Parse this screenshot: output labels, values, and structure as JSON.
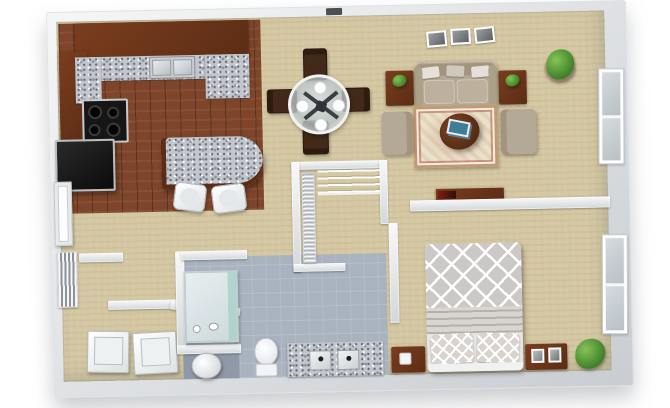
{
  "scene": {
    "type": "3d-floor-plan-render",
    "description": "Top-down 3D rendering of a one-bedroom one-bath apartment floor plan, no text labels",
    "view": "top-down with slight perspective tilt"
  },
  "colors": {
    "background": "#ffffff",
    "wall_mid": "#c9cdd1",
    "carpet": "#d4c7a1",
    "wood_floor": "#7e452a",
    "cabinet": "#5c2d15",
    "cabinet_light": "#7a3d1e",
    "granite": "#c3c7cd",
    "tile": "#a9b3bf",
    "tile_dark": "#8f99a7",
    "glass_shower": "#a8cfc9",
    "black_appliance": "#161616",
    "white_fixture": "#f4f6f7",
    "sofa": "#b4a896",
    "pillow": "#e6e1d8",
    "rug": "#eae1cb",
    "rug_border": "#bf9a72",
    "dark_wood": "#5f3319",
    "plant": "#4e8f33",
    "plant_dark": "#2f6b1e",
    "bed_cover": "#ccc8c5",
    "magazine_blue": "#3e7d96"
  },
  "rooms": [
    {
      "id": "kitchen",
      "name": "Kitchen",
      "floor": "hardwood",
      "items": [
        "L-shaped cherry-wood cabinets",
        "granite countertops",
        "double-basin sink",
        "four-burner cooktop",
        "refrigerator",
        "granite breakfast bar",
        "two bar stools"
      ]
    },
    {
      "id": "dining",
      "name": "Dining Area",
      "floor": "carpet",
      "items": [
        "round glass dining table",
        "four dark-wood dining chairs",
        "four white place settings"
      ]
    },
    {
      "id": "living",
      "name": "Living Room",
      "floor": "carpet",
      "items": [
        "three-cushion sofa with throw pillows",
        "two end tables with plants",
        "two armchairs",
        "oval wood coffee table",
        "magazines",
        "patterned area rug",
        "corner potted plant",
        "three framed wall pictures",
        "media console"
      ]
    },
    {
      "id": "bedroom",
      "name": "Bedroom",
      "floor": "carpet",
      "items": [
        "bed with trellis-pattern comforter",
        "two patterned pillows",
        "two wood nightstands",
        "framed photos",
        "potted plant"
      ]
    },
    {
      "id": "bathroom",
      "name": "Bathroom",
      "floor": "tile",
      "items": [
        "glass-door shower stall",
        "toilet",
        "granite double-sink vanity",
        "round laundry hamper"
      ]
    },
    {
      "id": "laundry",
      "name": "Laundry Area",
      "floor": "carpet",
      "items": [
        "washer",
        "dryer"
      ]
    },
    {
      "id": "entry",
      "name": "Entry / Hallway",
      "floor": "carpet",
      "items": [
        "entry door",
        "louvered utility closet door"
      ]
    },
    {
      "id": "closet",
      "name": "Storage Closet",
      "floor": "carpet",
      "items": [
        "louvered closet door",
        "wire shelving"
      ]
    }
  ],
  "windows": [
    {
      "wall": "right",
      "room": "living"
    },
    {
      "wall": "right",
      "room": "bedroom"
    }
  ]
}
